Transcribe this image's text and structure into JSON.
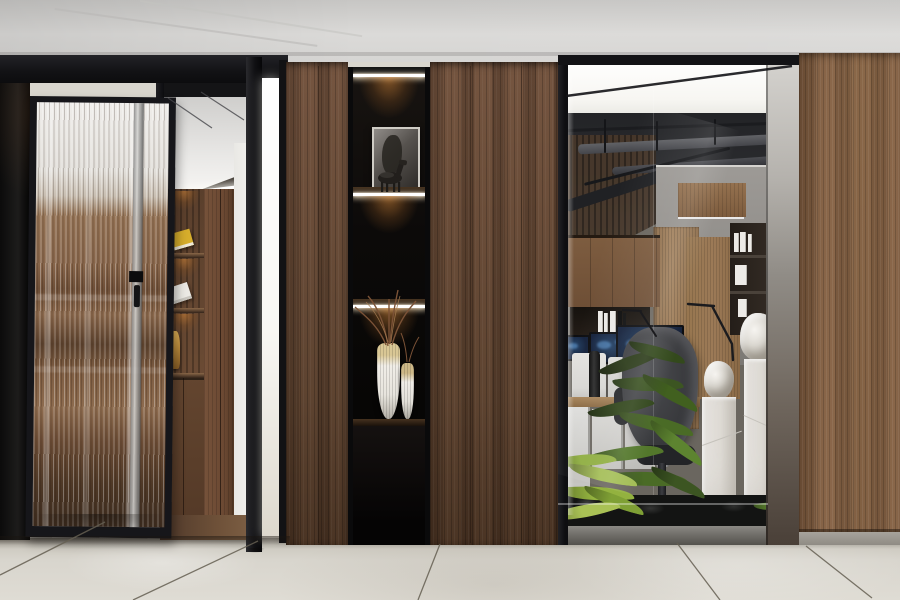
{
  "scene": {
    "type": "interior-architecture-photo",
    "description": "Modern office interior: black-framed fluted glass pivot door opening to a lit bookshelf room, dark walnut wood partition wall with backlit black display niche (framed horse artwork, horse figurine, two white-and-gold vases with dried branches), glass-walled open office with desks, blue map monitors, desk lamps, black task chair, white carved stone pedestals and green ferns over a dark rock bed, large beige tile floor",
    "objects": [
      "ceiling",
      "fluted-glass-door",
      "doorway-bookshelf-room",
      "display-niche",
      "horse-artwork",
      "horse-figurine",
      "decor-vases",
      "dried-branches",
      "wood-panel-wall",
      "glass-partition",
      "open-office",
      "desk-monitors",
      "desk-lamps",
      "office-chair",
      "stone-pedestals",
      "stone-sculptures",
      "indoor-plants",
      "rock-bed",
      "tile-floor"
    ]
  },
  "palette": {
    "ceiling": "#d6d5d3",
    "floor": "#d9d6ce",
    "grout": "#655f52",
    "blackFrame": "#16161a",
    "blackPanel": "#111110",
    "woodDark": "#5d4330",
    "woodMid": "#755540",
    "woodRight": "#8a674a",
    "nicheBlack": "#0b0a09",
    "ledWhite": "#ffffff",
    "innerWhite": "#f3f2ef",
    "innerWood": "#6b4b34",
    "bookYellow": "#d7ae2c",
    "gold": "#c2913f",
    "officeLum": "#f7f6f2",
    "officeCeilDark": "#2c2d30",
    "officeWallGray": "#918e8a",
    "officeWoodLight": "#a2815d",
    "screenNavy": "#16233d",
    "screenBlue": "#4f86c0",
    "monitorWhite": "#d8d7d4",
    "chairDark": "#36373a",
    "pedestalWhite": "#eae8e3",
    "metalStrip": "#908c86",
    "plantDark": "#33491c",
    "plantMid": "#53772b",
    "plantBright": "#a3bd55",
    "rockDark": "#131413",
    "baseGray": "#a7a39c",
    "lightStrip": "#f8f7f3"
  }
}
